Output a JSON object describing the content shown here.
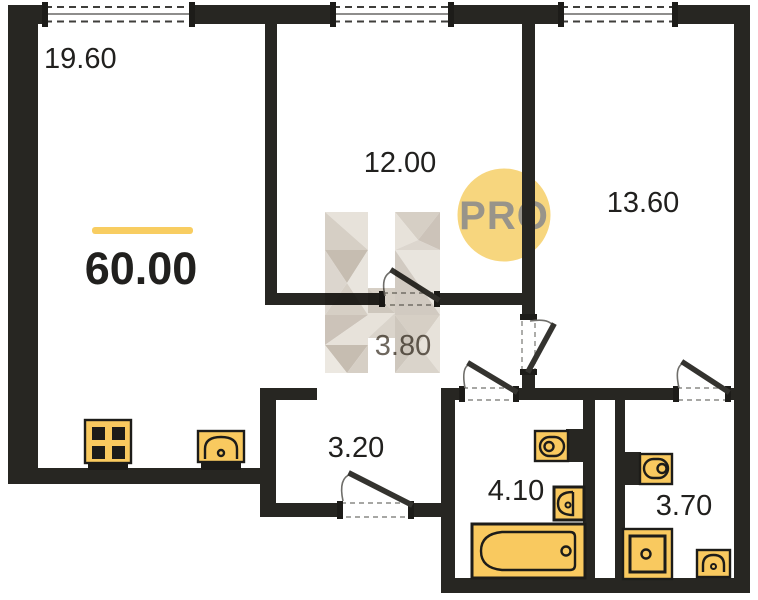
{
  "plan": {
    "total_area": "60.00",
    "rooms": [
      {
        "name": "living-room",
        "area": "19.60"
      },
      {
        "name": "room-12",
        "area": "12.00"
      },
      {
        "name": "room-13",
        "area": "13.60"
      },
      {
        "name": "hall",
        "area": "3.80"
      },
      {
        "name": "corridor",
        "area": "3.20"
      },
      {
        "name": "bathroom",
        "area": "4.10"
      },
      {
        "name": "toilet-room",
        "area": "3.70"
      }
    ],
    "watermark": {
      "label": "PRO"
    },
    "fixtures": [
      "stove",
      "kitchen-sink",
      "toilet",
      "washbasin",
      "bathtub",
      "toilet",
      "washing-machine",
      "washbasin"
    ],
    "colors": {
      "wall": "#272622",
      "fixture": "#F9C95F",
      "fixture_stroke": "#1D1C19",
      "accent_line": "#F8CD61",
      "watermark_circle": "#F7D67E",
      "watermark_text": "#98948A",
      "facet_light": "#E7E2DA",
      "facet_mid": "#D6CFC5",
      "facet_dark": "#C6BDB1",
      "label": "#21201E",
      "label_muted": "#6E675E"
    }
  }
}
